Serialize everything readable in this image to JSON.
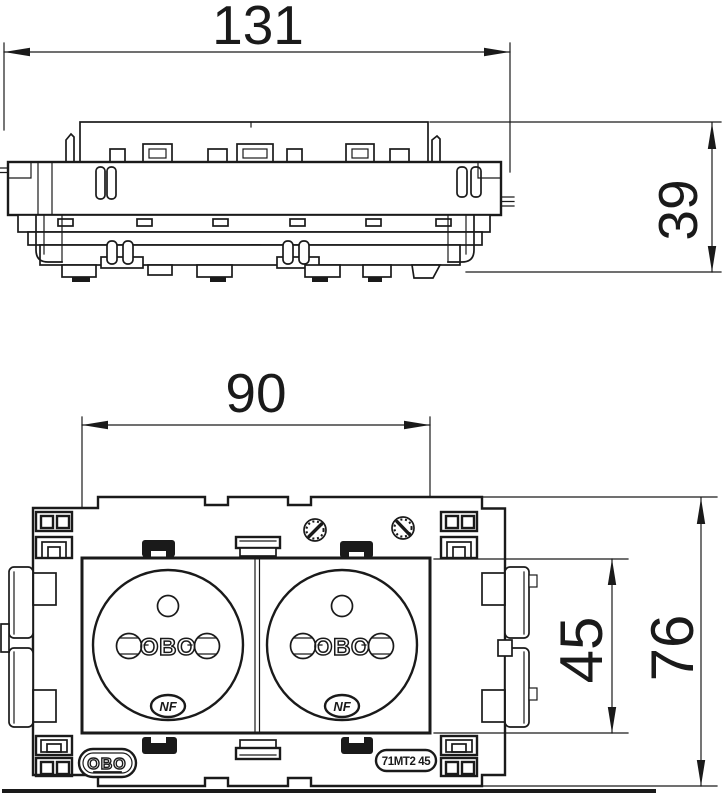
{
  "dimensions": {
    "side_width": "131",
    "side_height": "39",
    "front_width": "90",
    "socket_height": "45",
    "front_height": "76"
  },
  "markings": {
    "brand": "OBO",
    "emboss": "OBO",
    "nf": "NF",
    "type": "71MT2 45"
  },
  "colors": {
    "line": "#1a1a1a",
    "background": "#ffffff"
  }
}
